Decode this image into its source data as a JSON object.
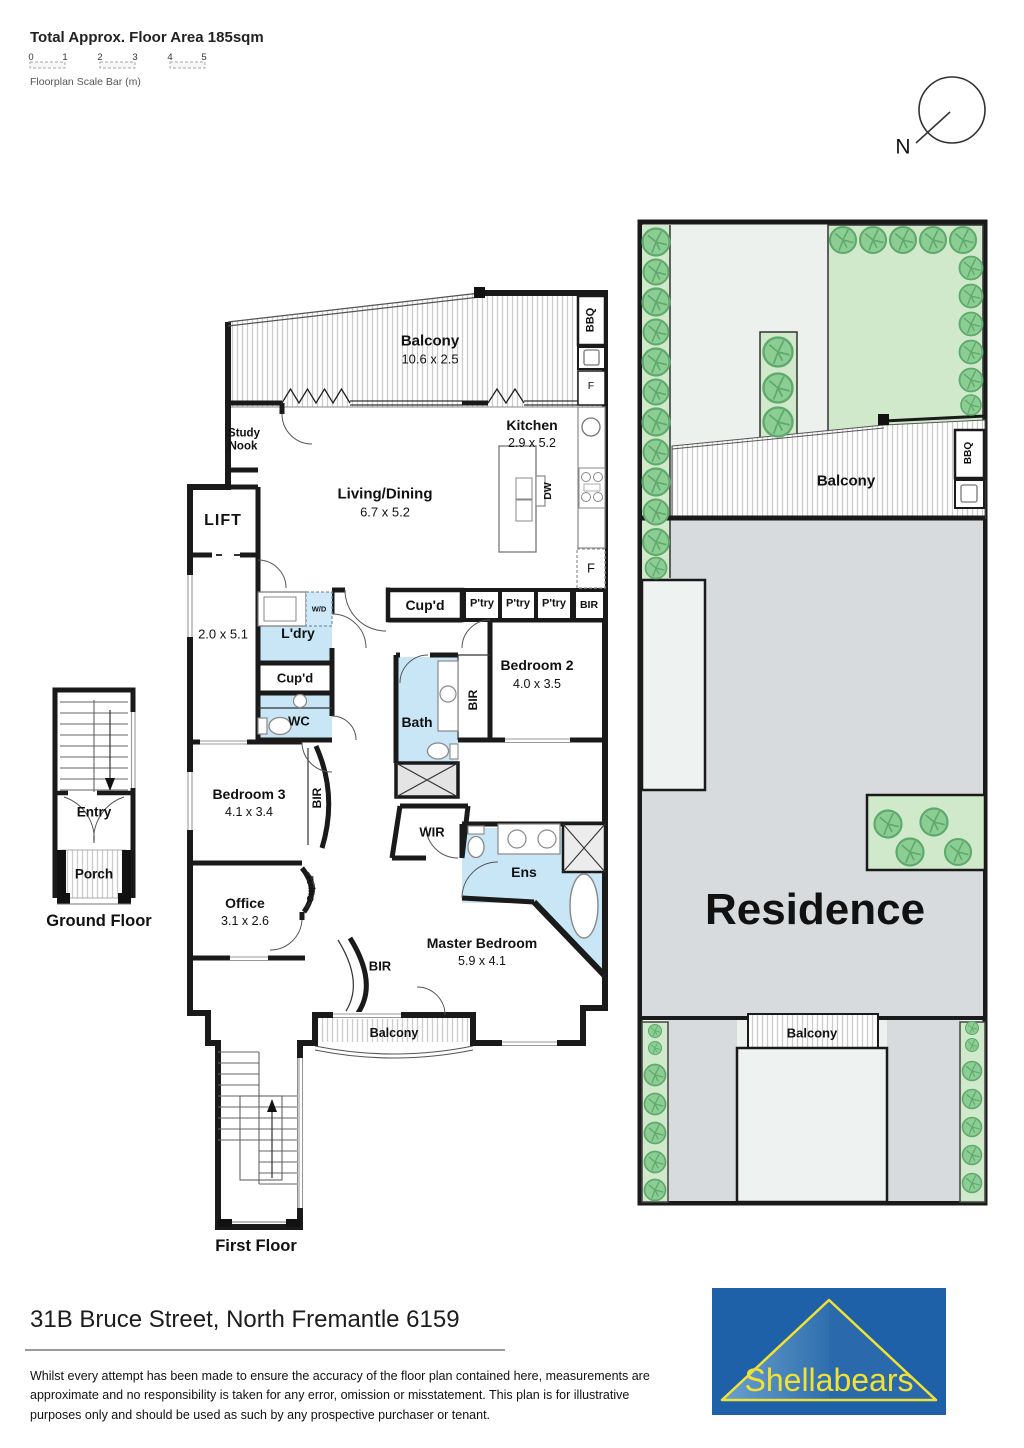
{
  "header": {
    "floor_area_label": "Total Approx. Floor Area 185sqm",
    "scale_ticks": [
      "0",
      "1",
      "2",
      "3",
      "4",
      "5"
    ],
    "scale_caption": "Floorplan Scale Bar (m)",
    "compass_n": "N"
  },
  "first_floor": {
    "balcony_top": {
      "name": "Balcony",
      "dims": "10.6 x 2.5"
    },
    "study_nook": {
      "line1": "Study",
      "line2": "Nook"
    },
    "kitchen": {
      "name": "Kitchen",
      "dims": "2.9 x 5.2"
    },
    "living_dining": {
      "name": "Living/Dining",
      "dims": "6.7 x 5.2"
    },
    "lift": "LIFT",
    "corridor_dims": "2.0 x 5.1",
    "bbq": "BBQ",
    "fridge_balcony": "F",
    "fridge_kitchen": "F",
    "dishwasher": "DW",
    "washer_dryer": "W/D",
    "laundry": "L'dry",
    "cupboard_laundry": "Cup'd",
    "wc": "WC",
    "cupboard_hall": "Cup'd",
    "pantries": [
      "P'try",
      "P'try",
      "P'try"
    ],
    "bir_kitchen": "BIR",
    "bedroom2": {
      "name": "Bedroom 2",
      "dims": "4.0 x 3.5"
    },
    "bir_bedroom2": "BIR",
    "bath": "Bath",
    "bedroom3": {
      "name": "Bedroom 3",
      "dims": "4.1 x 3.4"
    },
    "bir_bedroom3": "BIR",
    "wir": "WIR",
    "ens": "Ens",
    "cupboard_office": "Cup'd",
    "office": {
      "name": "Office",
      "dims": "3.1 x 2.6"
    },
    "master_bedroom": {
      "name": "Master Bedroom",
      "dims": "5.9 x 4.1"
    },
    "bir_master": "BIR",
    "balcony_front": "Balcony",
    "caption": "First Floor"
  },
  "ground_floor": {
    "entry": "Entry",
    "porch": "Porch",
    "caption": "Ground Floor"
  },
  "site_plan": {
    "balcony_rear": "Balcony",
    "bbq": "BBQ",
    "residence": "Residence",
    "balcony_front": "Balcony"
  },
  "footer": {
    "address": "31B Bruce Street, North Fremantle 6159",
    "disclaimer": "Whilst every attempt has been made to ensure the accuracy of the floor plan contained here, measurements are approximate and no responsibility is taken for any error, omission or misstatement. This plan is for illustrative purposes only and should be used as such by any prospective purchaser or tenant.",
    "brand": "Shellabears"
  },
  "colors": {
    "wall": "#1a1a1a",
    "wet_area": "#c9e6f7",
    "tree": "#8ccd93",
    "garden": "#cfe9ca",
    "residence_fill": "#d8dbde",
    "logo_blue": "#1e61a8",
    "logo_yellow": "#f2e135"
  }
}
